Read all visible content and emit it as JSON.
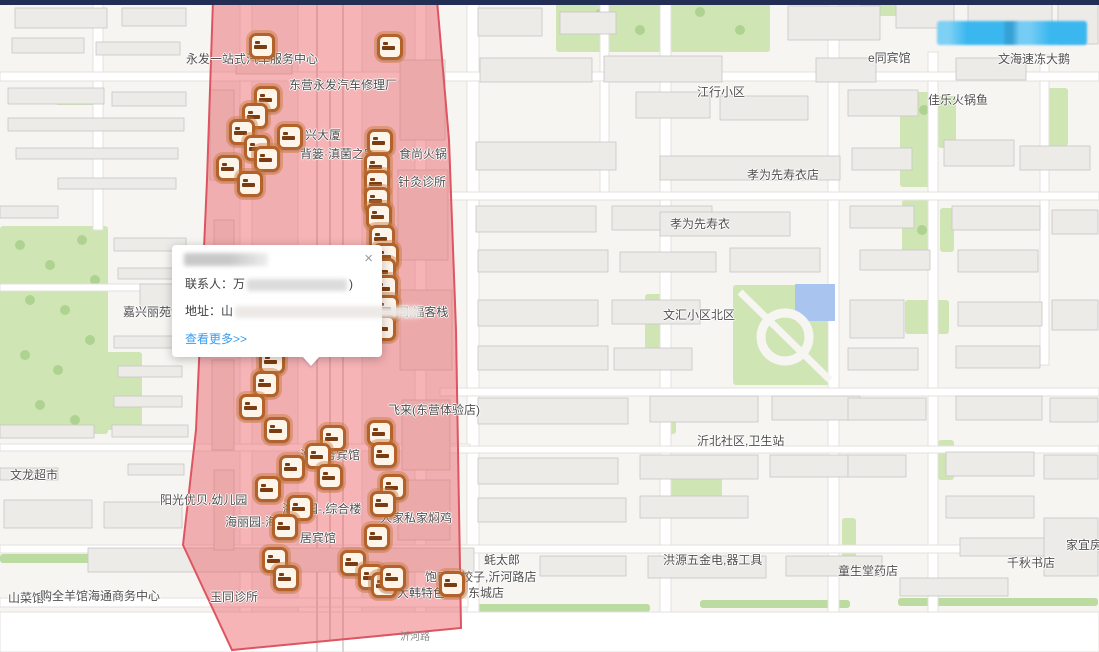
{
  "colors": {
    "highlight_fill": "rgba(235,88,96,0.45)",
    "highlight_stroke": "#dd5560",
    "marker_orange": "#b2622a",
    "link_blue": "#3a9bf0",
    "button_blue": "#3ab7ef",
    "top_bar_navy": "#232e54",
    "pool_blue": "#a9c4ef"
  },
  "popup": {
    "close_glyph": "×",
    "contact_label": "联系人：",
    "contact_prefix": "万",
    "contact_suffix": ")",
    "address_label": "地址：",
    "address_prefix": "山",
    "more_link": "查看更多>>"
  },
  "map": {
    "region": {
      "points": "213,0 437,0 449,140 456,330 461,628 232,650 183,545 196,430 207,180"
    },
    "labels": [
      {
        "t": "永发一站式汽车服务中心",
        "x": 186,
        "y": 50
      },
      {
        "t": "东营永发汽车修理厂",
        "x": 289,
        "y": 76
      },
      {
        "t": "兴大厦",
        "x": 305,
        "y": 126
      },
      {
        "t": "背篓·滇菌之家",
        "x": 300,
        "y": 145
      },
      {
        "t": "食尚火锅",
        "x": 399,
        "y": 145
      },
      {
        "t": "针灸诊所",
        "x": 398,
        "y": 173
      },
      {
        "t": "胡同,福客栈",
        "x": 385,
        "y": 303
      },
      {
        "t": "飞来(东营体验店)",
        "x": 388,
        "y": 401
      },
      {
        "t": "浩商务宾馆",
        "x": 300,
        "y": 446
      },
      {
        "t": "阳光优贝,幼儿园",
        "x": 160,
        "y": 491
      },
      {
        "t": "海丽园-,综合楼",
        "x": 282,
        "y": 500
      },
      {
        "t": "海丽园-海",
        "x": 225,
        "y": 513
      },
      {
        "t": "居宾馆",
        "x": 300,
        "y": 529
      },
      {
        "t": "人家私家焖鸡",
        "x": 380,
        "y": 509
      },
      {
        "t": "文龙超市",
        "x": 10,
        "y": 466
      },
      {
        "t": "嘉兴丽苑",
        "x": 123,
        "y": 303
      },
      {
        "t": "玉同诊所",
        "x": 210,
        "y": 588
      },
      {
        "t": "山菜馆",
        "x": 8,
        "y": 589
      },
      {
        "t": "购全羊馆海通商务中心",
        "x": 40,
        "y": 587
      },
      {
        "t": "蚝太郎",
        "x": 484,
        "y": 551
      },
      {
        "t": "饱口福饺子,沂河路店",
        "x": 425,
        "y": 568
      },
      {
        "t": "大韩特色",
        "x": 397,
        "y": 584
      },
      {
        "t": "东城店",
        "x": 468,
        "y": 584
      },
      {
        "t": "洪源五金电,器工具",
        "x": 663,
        "y": 551
      },
      {
        "t": "童生堂药店",
        "x": 838,
        "y": 562
      },
      {
        "t": "千秋书店",
        "x": 1007,
        "y": 554
      },
      {
        "t": "家宜房",
        "x": 1066,
        "y": 536
      },
      {
        "t": "江行小区",
        "x": 697,
        "y": 83
      },
      {
        "t": "e同宾馆",
        "x": 868,
        "y": 49
      },
      {
        "t": "佳乐火锅鱼",
        "x": 928,
        "y": 91
      },
      {
        "t": "文海速冻大鹅",
        "x": 998,
        "y": 50
      },
      {
        "t": "孝为先寿衣店",
        "x": 747,
        "y": 166
      },
      {
        "t": "孝为先寿衣",
        "x": 670,
        "y": 215
      },
      {
        "t": "文汇小区北区",
        "x": 663,
        "y": 306
      },
      {
        "t": "沂北社区,卫生站",
        "x": 697,
        "y": 432
      },
      {
        "t": "沂河路",
        "x": 400,
        "y": 628,
        "s": "road"
      }
    ],
    "markers": [
      [
        262,
        46
      ],
      [
        390,
        47
      ],
      [
        267,
        99
      ],
      [
        255,
        116
      ],
      [
        242,
        132
      ],
      [
        290,
        137
      ],
      [
        257,
        148
      ],
      [
        267,
        159
      ],
      [
        229,
        168
      ],
      [
        250,
        184
      ],
      [
        380,
        142
      ],
      [
        377,
        166
      ],
      [
        377,
        183
      ],
      [
        377,
        200
      ],
      [
        379,
        216
      ],
      [
        382,
        238
      ],
      [
        386,
        256
      ],
      [
        383,
        271
      ],
      [
        385,
        288
      ],
      [
        386,
        308
      ],
      [
        383,
        328
      ],
      [
        272,
        361
      ],
      [
        266,
        384
      ],
      [
        252,
        407
      ],
      [
        277,
        430
      ],
      [
        333,
        438
      ],
      [
        318,
        456
      ],
      [
        292,
        468
      ],
      [
        330,
        477
      ],
      [
        268,
        489
      ],
      [
        300,
        508
      ],
      [
        285,
        527
      ],
      [
        380,
        433
      ],
      [
        384,
        455
      ],
      [
        393,
        487
      ],
      [
        383,
        504
      ],
      [
        377,
        537
      ],
      [
        275,
        560
      ],
      [
        286,
        578
      ],
      [
        353,
        563
      ],
      [
        371,
        577
      ],
      [
        384,
        585
      ],
      [
        393,
        578
      ],
      [
        452,
        584
      ]
    ]
  }
}
